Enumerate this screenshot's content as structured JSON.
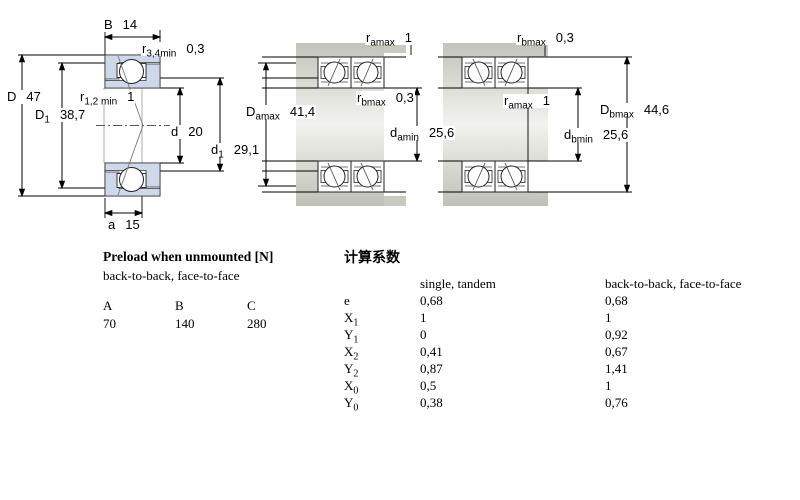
{
  "figures": {
    "single": {
      "description": "single angular contact ball bearing cross-section",
      "dims": {
        "B": {
          "sym": "B",
          "sub": "",
          "val": "14"
        },
        "r34": {
          "sym": "r",
          "sub": "3,4min",
          "val": "0,3"
        },
        "D": {
          "sym": "D",
          "sub": "",
          "val": "47"
        },
        "D1": {
          "sym": "D",
          "sub": "1",
          "val": "38,7"
        },
        "r12": {
          "sym": "r",
          "sub": "1,2 min",
          "val": "1"
        },
        "d": {
          "sym": "d",
          "sub": "",
          "val": "20"
        },
        "d1": {
          "sym": "d",
          "sub": "1",
          "val": "29,1"
        },
        "a": {
          "sym": "a",
          "sub": "",
          "val": "15"
        }
      }
    },
    "tandem": {
      "description": "tandem bearing pair mounted on shaft",
      "dims": {
        "ramax": {
          "sym": "r",
          "sub": "amax",
          "val": "1"
        },
        "rbmax": {
          "sym": "r",
          "sub": "bmax",
          "val": "0,3"
        },
        "Damax": {
          "sym": "D",
          "sub": "amax",
          "val": "41,4"
        },
        "damin": {
          "sym": "d",
          "sub": "amin",
          "val": "25,6"
        }
      }
    },
    "paired": {
      "description": "back-to-back bearing pair mounted on shaft",
      "dims": {
        "rbmax": {
          "sym": "r",
          "sub": "bmax",
          "val": "0,3"
        },
        "ramax": {
          "sym": "r",
          "sub": "amax",
          "val": "1"
        },
        "Dbmax": {
          "sym": "D",
          "sub": "bmax",
          "val": "44,6"
        },
        "dbmin": {
          "sym": "d",
          "sub": "bmin",
          "val": "25,6"
        }
      }
    }
  },
  "preload": {
    "title": "Preload when unmounted [N]",
    "subtitle": "back-to-back, face-to-face",
    "columns": [
      "A",
      "B",
      "C"
    ],
    "values": [
      "70",
      "140",
      "280"
    ]
  },
  "factors": {
    "title": "计算系数",
    "col_single": "single, tandem",
    "col_paired": "back-to-back, face-to-face",
    "rows": [
      {
        "sym": "e",
        "sub": "",
        "single": "0,68",
        "paired": "0,68"
      },
      {
        "sym": "X",
        "sub": "1",
        "single": "1",
        "paired": "1"
      },
      {
        "sym": "Y",
        "sub": "1",
        "single": "0",
        "paired": "0,92"
      },
      {
        "sym": "X",
        "sub": "2",
        "single": "0,41",
        "paired": "0,67"
      },
      {
        "sym": "Y",
        "sub": "2",
        "single": "0,87",
        "paired": "1,41"
      },
      {
        "sym": "X",
        "sub": "0",
        "single": "0,5",
        "paired": "1"
      },
      {
        "sym": "Y",
        "sub": "0",
        "single": "0,38",
        "paired": "0,76"
      }
    ]
  },
  "colors": {
    "bearing_ring_fill": "#cdd9ea",
    "steel_gray": "#c8cabf",
    "line": "#000000"
  }
}
